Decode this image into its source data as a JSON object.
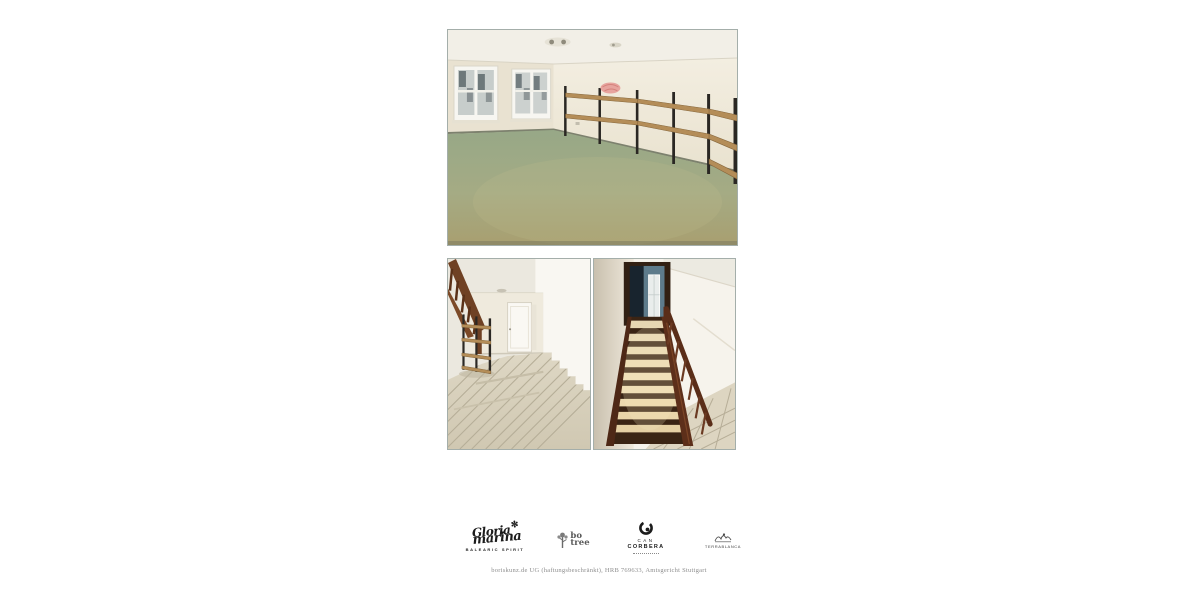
{
  "page": {
    "background": "#ffffff",
    "type_hint": "real-estate expose photo page"
  },
  "brand_logos": {
    "gloria_marina": {
      "word1": "Gloria",
      "word2": "marina",
      "star": "✼",
      "subtitle": "BALEARIC SPIRIT"
    },
    "bo_tree": {
      "word1": "bo",
      "word2": "tree"
    },
    "can_corbera": {
      "word1": "CAN",
      "word2": "CORBERA"
    },
    "terra_blanca": {
      "label": "TERRABLANCA"
    }
  },
  "footer": {
    "imprint": "boriskunz.de UG (haftungsbeschränkt), HRB 769633, Amtsgericht Stuttgart"
  },
  "palette": {
    "photo_border": "#a4aeaa",
    "floor_green": "#a5ab84",
    "wall_cream": "#efe9da",
    "wood_brown": "#5d2f1a",
    "tile_beige": "#ddd5c1",
    "logo_ink": "#1c1c1c",
    "footer_gray": "#8e8e8e"
  }
}
